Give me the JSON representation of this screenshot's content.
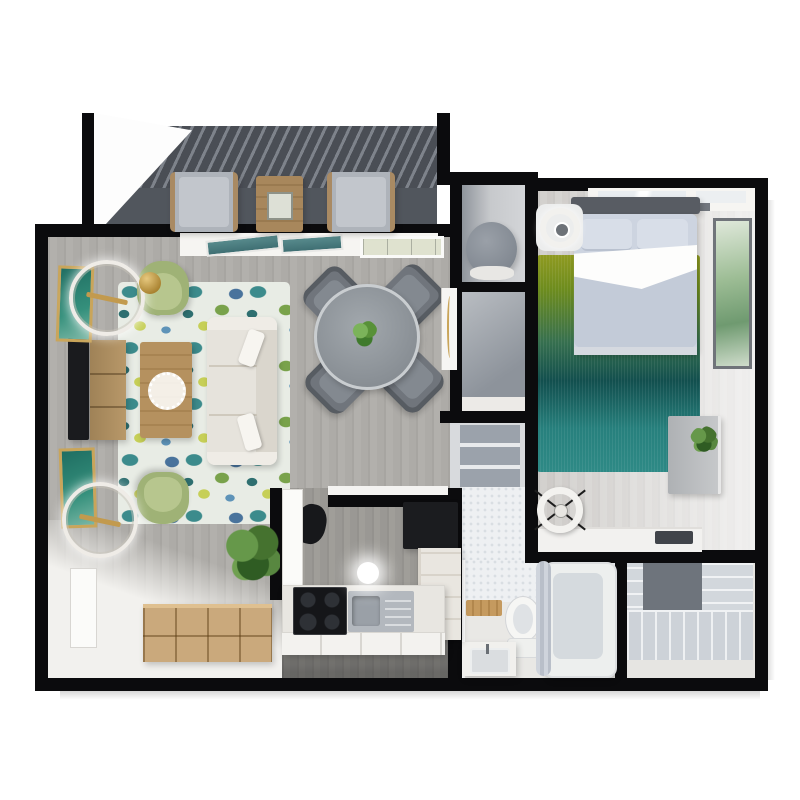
{
  "meta": {
    "title": "3D top-down floor plan render of a one-bedroom apartment",
    "canvas": "800x800",
    "style": "photoreal 3D dollhouse view, black cut walls on white background"
  },
  "palette": {
    "wall": "#0b0b0d",
    "wood_floor_gray": "#aca9a5",
    "light_floor": "#f2f1ee",
    "balcony_floor": "#4a4e55",
    "rug_teal": "#3c8b8c",
    "rug_green": "#79a24b",
    "rug_yellow": "#c6cf57",
    "rug_blue": "#49739c",
    "sofa_cream": "#e6e3dc",
    "armchair_sage": "#9fb276",
    "wood_furniture": "#b5915f",
    "dining_table_gray": "#8d939a",
    "bedding_blue_gray": "#c9d1de",
    "ombre_rug_top": "#8f9a21",
    "ombre_rug_bottom": "#2e8a86",
    "counter_white": "#e9e7e2",
    "appliance_black": "#17181b",
    "accent_gold": "#c9a55a",
    "plant_green": "#4e7d33",
    "bath_white": "#f4f4f2",
    "tile_light": "#eef0f2"
  },
  "rooms": [
    {
      "id": "balcony",
      "label": "Balcony",
      "furniture": [
        "lounge chair",
        "lounge chair",
        "wood side table with lantern"
      ],
      "floor": "dark slate with slatted shade shadows"
    },
    {
      "id": "living-room",
      "label": "Living Room",
      "furniture": [
        "paisley area rug",
        "cream sofa with two pillows",
        "sage armchair (top)",
        "sage armchair (bottom)",
        "wood coffee table with doily",
        "TV",
        "wood media console",
        "two gold-frame teal artworks",
        "two ring chandeliers",
        "gold pendant sphere",
        "wood cube storage unit",
        "potted plant",
        "open white door"
      ],
      "floor": "gray wood planks fading to white carpet"
    },
    {
      "id": "dining-area",
      "label": "Dining Area",
      "furniture": [
        "round gray dining table",
        "4 gray chairs",
        "green centerpiece plant"
      ],
      "windows": [
        "two tilted teal casement panes",
        "framed window"
      ]
    },
    {
      "id": "kitchen",
      "label": "Kitchen",
      "furniture": [
        "black refrigerator",
        "L-shaped white counter",
        "black cooktop",
        "stainless sink with drainboard",
        "corner cabinet",
        "ceiling light",
        "dark wall decor",
        "white door"
      ]
    },
    {
      "id": "utility-closet",
      "label": "Utility Closet",
      "furniture": [
        "round water heater tank"
      ]
    },
    {
      "id": "hall-closet",
      "label": "Hall Closet & Linen",
      "furniture": [
        "closet with shelves",
        "open door with gold trim"
      ]
    },
    {
      "id": "bedroom",
      "label": "Bedroom",
      "furniture": [
        "double bed with gray-blue bedding and white throw",
        "dark headboard",
        "ombre olive-to-teal rug",
        "ceiling fan",
        "green botanical wall art",
        "gray desk with plant",
        "spoked wheel decor",
        "window ledge with vent slot"
      ],
      "windows": [
        "top wall window with sill"
      ]
    },
    {
      "id": "bathroom",
      "label": "Bathroom",
      "furniture": [
        "toilet",
        "wood slat bench",
        "vanity with sink",
        "bathtub with curtain"
      ],
      "floor": "penny tile and light stone"
    },
    {
      "id": "walk-in-closet",
      "label": "Walk-in Closet",
      "furniture": [
        "wire shelving left",
        "wire shelving right",
        "bottom shelf run",
        "gray back panel"
      ]
    }
  ]
}
